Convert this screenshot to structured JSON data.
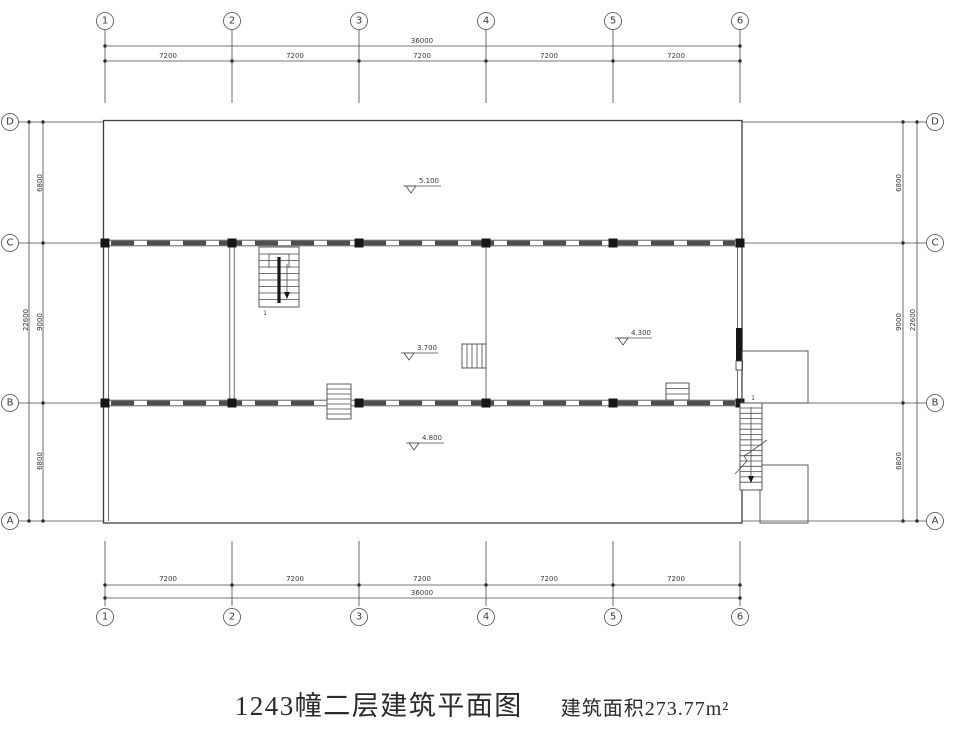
{
  "drawing": {
    "title": "1243幢二层建筑平面图",
    "area_note": "建筑面积273.77m²",
    "line_color": "#3f3f3f",
    "grid": {
      "columns": [
        "1",
        "2",
        "3",
        "4",
        "5",
        "6"
      ],
      "rows": [
        "D",
        "C",
        "B",
        "A"
      ]
    },
    "dims": {
      "top": {
        "total": "36000",
        "spans": [
          "7200",
          "7200",
          "7200",
          "7200",
          "7200"
        ]
      },
      "bottom": {
        "total": "36000",
        "spans": [
          "7200",
          "7200",
          "7200",
          "7200",
          "7200"
        ]
      },
      "left": {
        "total": "22600",
        "spans": [
          "6800",
          "9000",
          "6800"
        ]
      },
      "right": {
        "total": "22600",
        "spans": [
          "6800",
          "9000",
          "6800"
        ]
      }
    },
    "levels": {
      "upper_hall": "5.100",
      "middle_hall": "3.700",
      "right_room": "4.300",
      "lower_hall": "4.800"
    },
    "stair_labels": {
      "main": "1",
      "exterior": "1"
    }
  }
}
